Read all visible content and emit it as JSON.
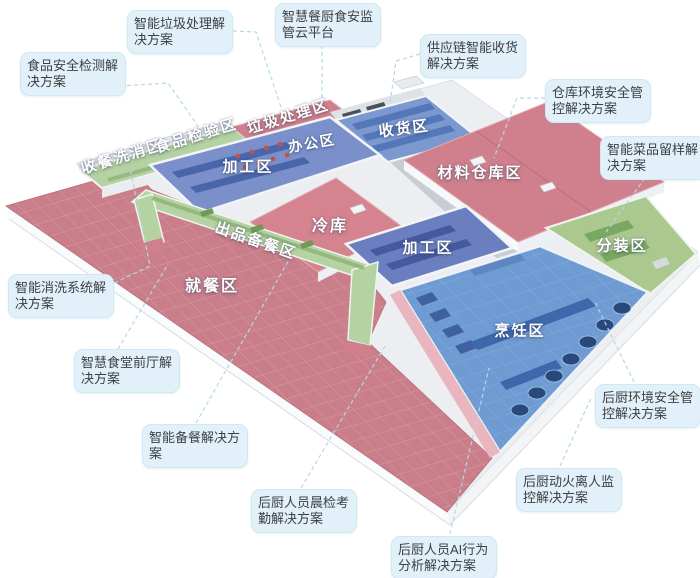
{
  "colors": {
    "callout_bg": "#e1f0f9",
    "callout_border": "#d0e8f4",
    "callout_text": "#3d4043",
    "connector": "#b3d8e9",
    "zone_label": "#ffffff",
    "dining_pink": "#c97e8a",
    "roof_red": "#d0808d",
    "room_blue": "#7b90cb",
    "cooking_blue": "#6f9bd3",
    "strip_green": "#b5d2a2",
    "office_yellow": "#e2cf96"
  },
  "zones": [
    {
      "id": "dish-return-washing",
      "label": "收餐洗消区"
    },
    {
      "id": "food-inspection",
      "label": "食品检验区"
    },
    {
      "id": "waste-disposal",
      "label": "垃圾处理区"
    },
    {
      "id": "office",
      "label": "办公区"
    },
    {
      "id": "receiving",
      "label": "收货区"
    },
    {
      "id": "processing-1",
      "label": "加工区"
    },
    {
      "id": "material-warehouse",
      "label": "材料仓库区"
    },
    {
      "id": "cold-storage",
      "label": "冷库"
    },
    {
      "id": "processing-2",
      "label": "加工区"
    },
    {
      "id": "serving-prep",
      "label": "出品备餐区"
    },
    {
      "id": "dining",
      "label": "就餐区"
    },
    {
      "id": "portioning",
      "label": "分装区"
    },
    {
      "id": "cooking",
      "label": "烹饪区"
    }
  ],
  "callouts": [
    {
      "id": "food-safety-testing",
      "text": "食品安全检测解决方案"
    },
    {
      "id": "smart-waste-disposal",
      "text": "智能垃圾处理解决方案"
    },
    {
      "id": "smart-kitchen-cloud-platform",
      "text": "智慧餐厨食安监管云平台"
    },
    {
      "id": "supply-chain-receiving",
      "text": "供应链智能收货解决方案"
    },
    {
      "id": "warehouse-env-safety",
      "text": "仓库环境安全管控解决方案"
    },
    {
      "id": "smart-dish-sampling",
      "text": "智能菜品留样解决方案"
    },
    {
      "id": "smart-washing-system",
      "text": "智能消洗系统解决方案"
    },
    {
      "id": "canteen-front-hall",
      "text": "智慧食堂前厅解决方案"
    },
    {
      "id": "smart-meal-prep",
      "text": "智能备餐解决方案"
    },
    {
      "id": "staff-morning-check",
      "text": "后厨人员晨检考勤解决方案"
    },
    {
      "id": "staff-ai-behavior",
      "text": "后厨人员AI行为分析解决方案"
    },
    {
      "id": "fire-unattended-monitoring",
      "text": "后厨动火离人监控解决方案"
    },
    {
      "id": "kitchen-env-safety",
      "text": "后厨环境安全管控解决方案"
    }
  ]
}
